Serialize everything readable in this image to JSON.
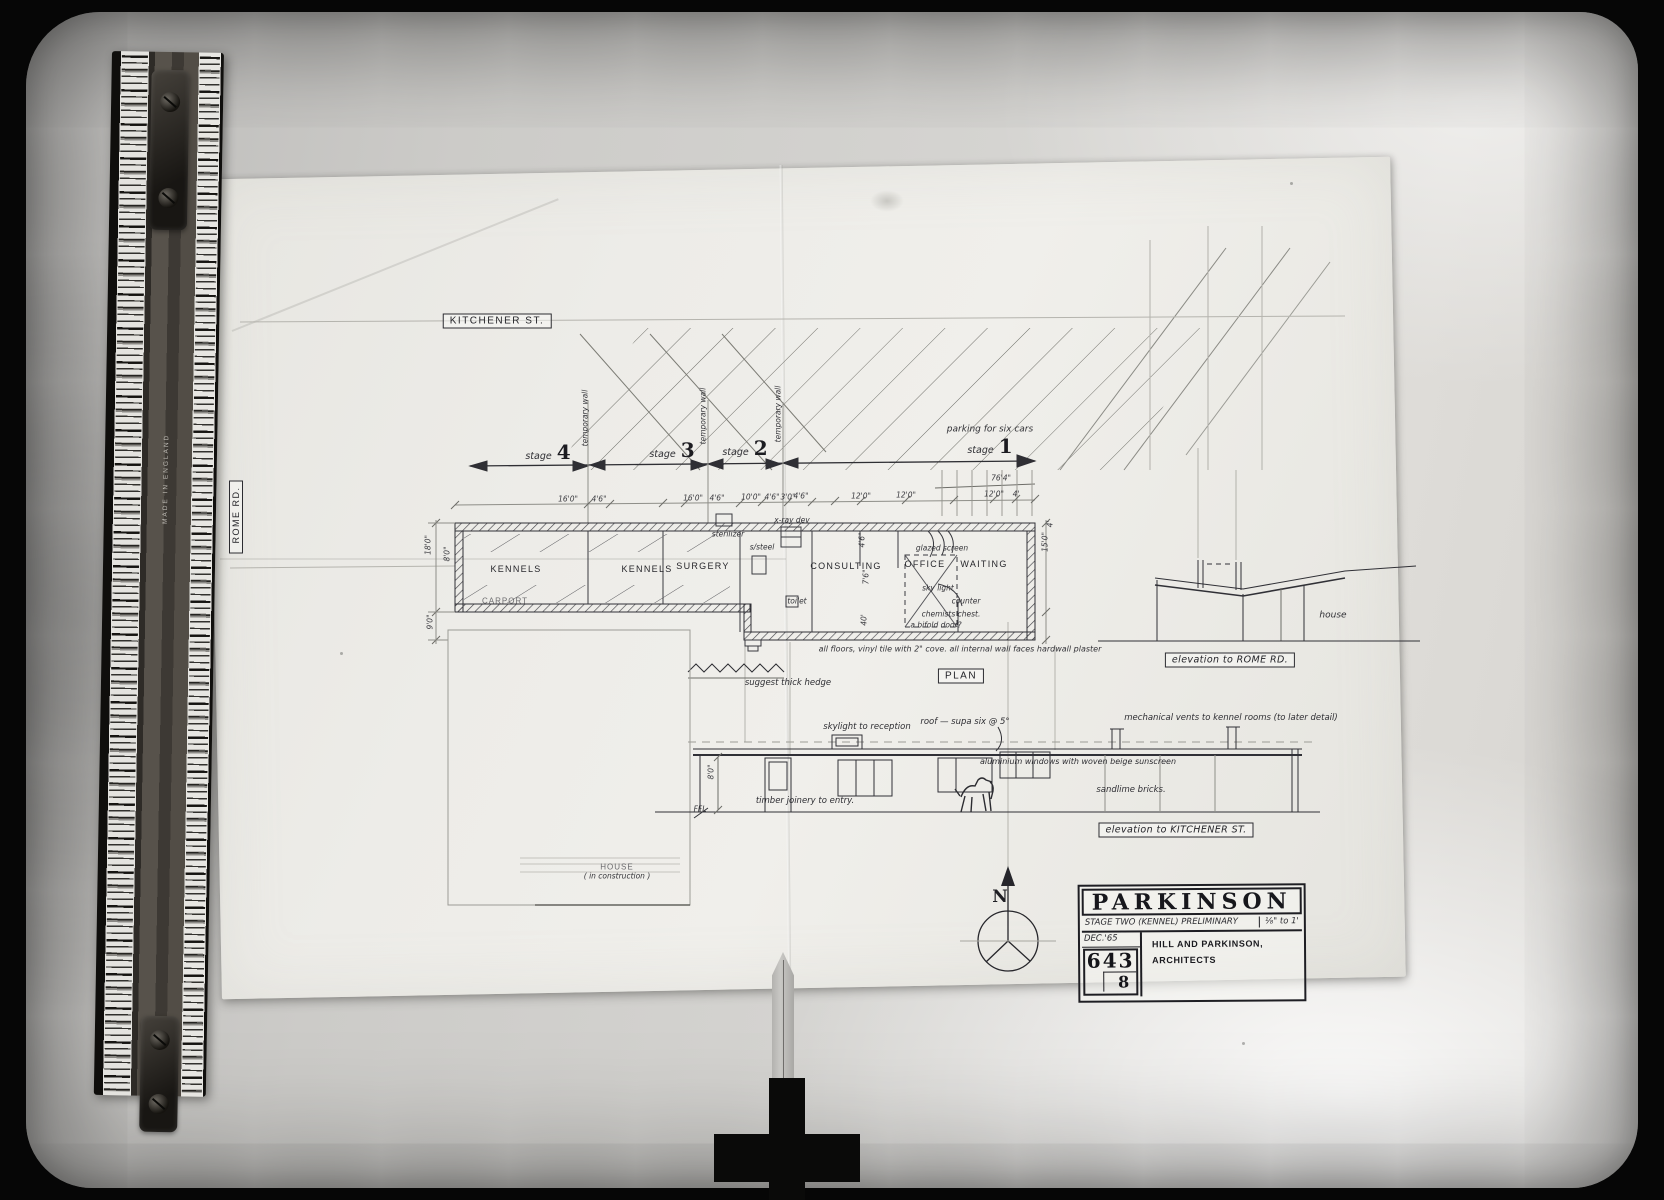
{
  "ruler": {
    "origin": "MADE IN ENGLAND"
  },
  "streets": {
    "top": "KITCHENER ST.",
    "left": "ROME RD."
  },
  "stages": {
    "labels": [
      {
        "word": "stage",
        "num": "4"
      },
      {
        "word": "stage",
        "num": "3"
      },
      {
        "word": "stage",
        "num": "2"
      },
      {
        "word": "stage",
        "num": "1"
      }
    ],
    "temporary_wall": "temporary wall",
    "parking_note": "parking for six cars",
    "overall_dim": "76'4\""
  },
  "plan": {
    "title": "PLAN",
    "rooms": [
      "KENNELS",
      "KENNELS",
      "SURGERY",
      "CONSULTING",
      "OFFICE",
      "WAITING"
    ],
    "fixtures": {
      "sterilizer": "sterilizer",
      "s_steel": "s/steel",
      "xray": "x-ray dev",
      "toilet": "toilet",
      "glazed_screen": "glazed screen",
      "skylight": "sky light",
      "counter": "counter",
      "chemists_chest": "chemists chest.",
      "bifold": "a bifold door?"
    },
    "floor_note": "all floors, vinyl tile with 2\" cove.    all internal wall faces hardwall plaster",
    "carport": "CARPORT",
    "hedge_note": "suggest thick hedge",
    "house": {
      "line1": "HOUSE",
      "line2": "( in construction )"
    },
    "dims_row": [
      "16'0\"",
      "4'6\"",
      "16'0\"",
      "4'6\"",
      "10'0\"",
      "4'6\"",
      "3'0\"",
      "4'6\"",
      "12'0\"",
      "12'0\"",
      "12'0\"",
      "4'"
    ],
    "dims_left": [
      "18'0\"",
      "8'0\"",
      "9'0\""
    ],
    "dims_right": [
      "4'",
      "15'0\""
    ],
    "dims_inner": [
      "4'6\"",
      "7'6\"",
      "40'"
    ]
  },
  "rome_elevation": {
    "caption": "elevation to ROME RD.",
    "house": "house"
  },
  "kitchener_elevation": {
    "caption": "elevation to KITCHENER ST.",
    "skylight": "skylight to reception",
    "roof": "roof — supa six @ 5°",
    "vents": "mechanical vents to kennel rooms (to later detail)",
    "windows": "aluminium windows with woven beige sunscreen",
    "bricks": "sandlime bricks.",
    "joinery": "timber joinery to entry.",
    "ffl": "FFL",
    "height": "8'0\""
  },
  "north": {
    "letter": "N"
  },
  "title_block": {
    "name": "PARKINSON",
    "stage_line": "STAGE TWO (KENNEL) PRELIMINARY",
    "scale": "⅛\" to 1'",
    "date": "DEC.'65",
    "job": "643",
    "sheet": "8",
    "firm_line1": "HILL AND PARKINSON,",
    "firm_line2": "ARCHITECTS"
  }
}
